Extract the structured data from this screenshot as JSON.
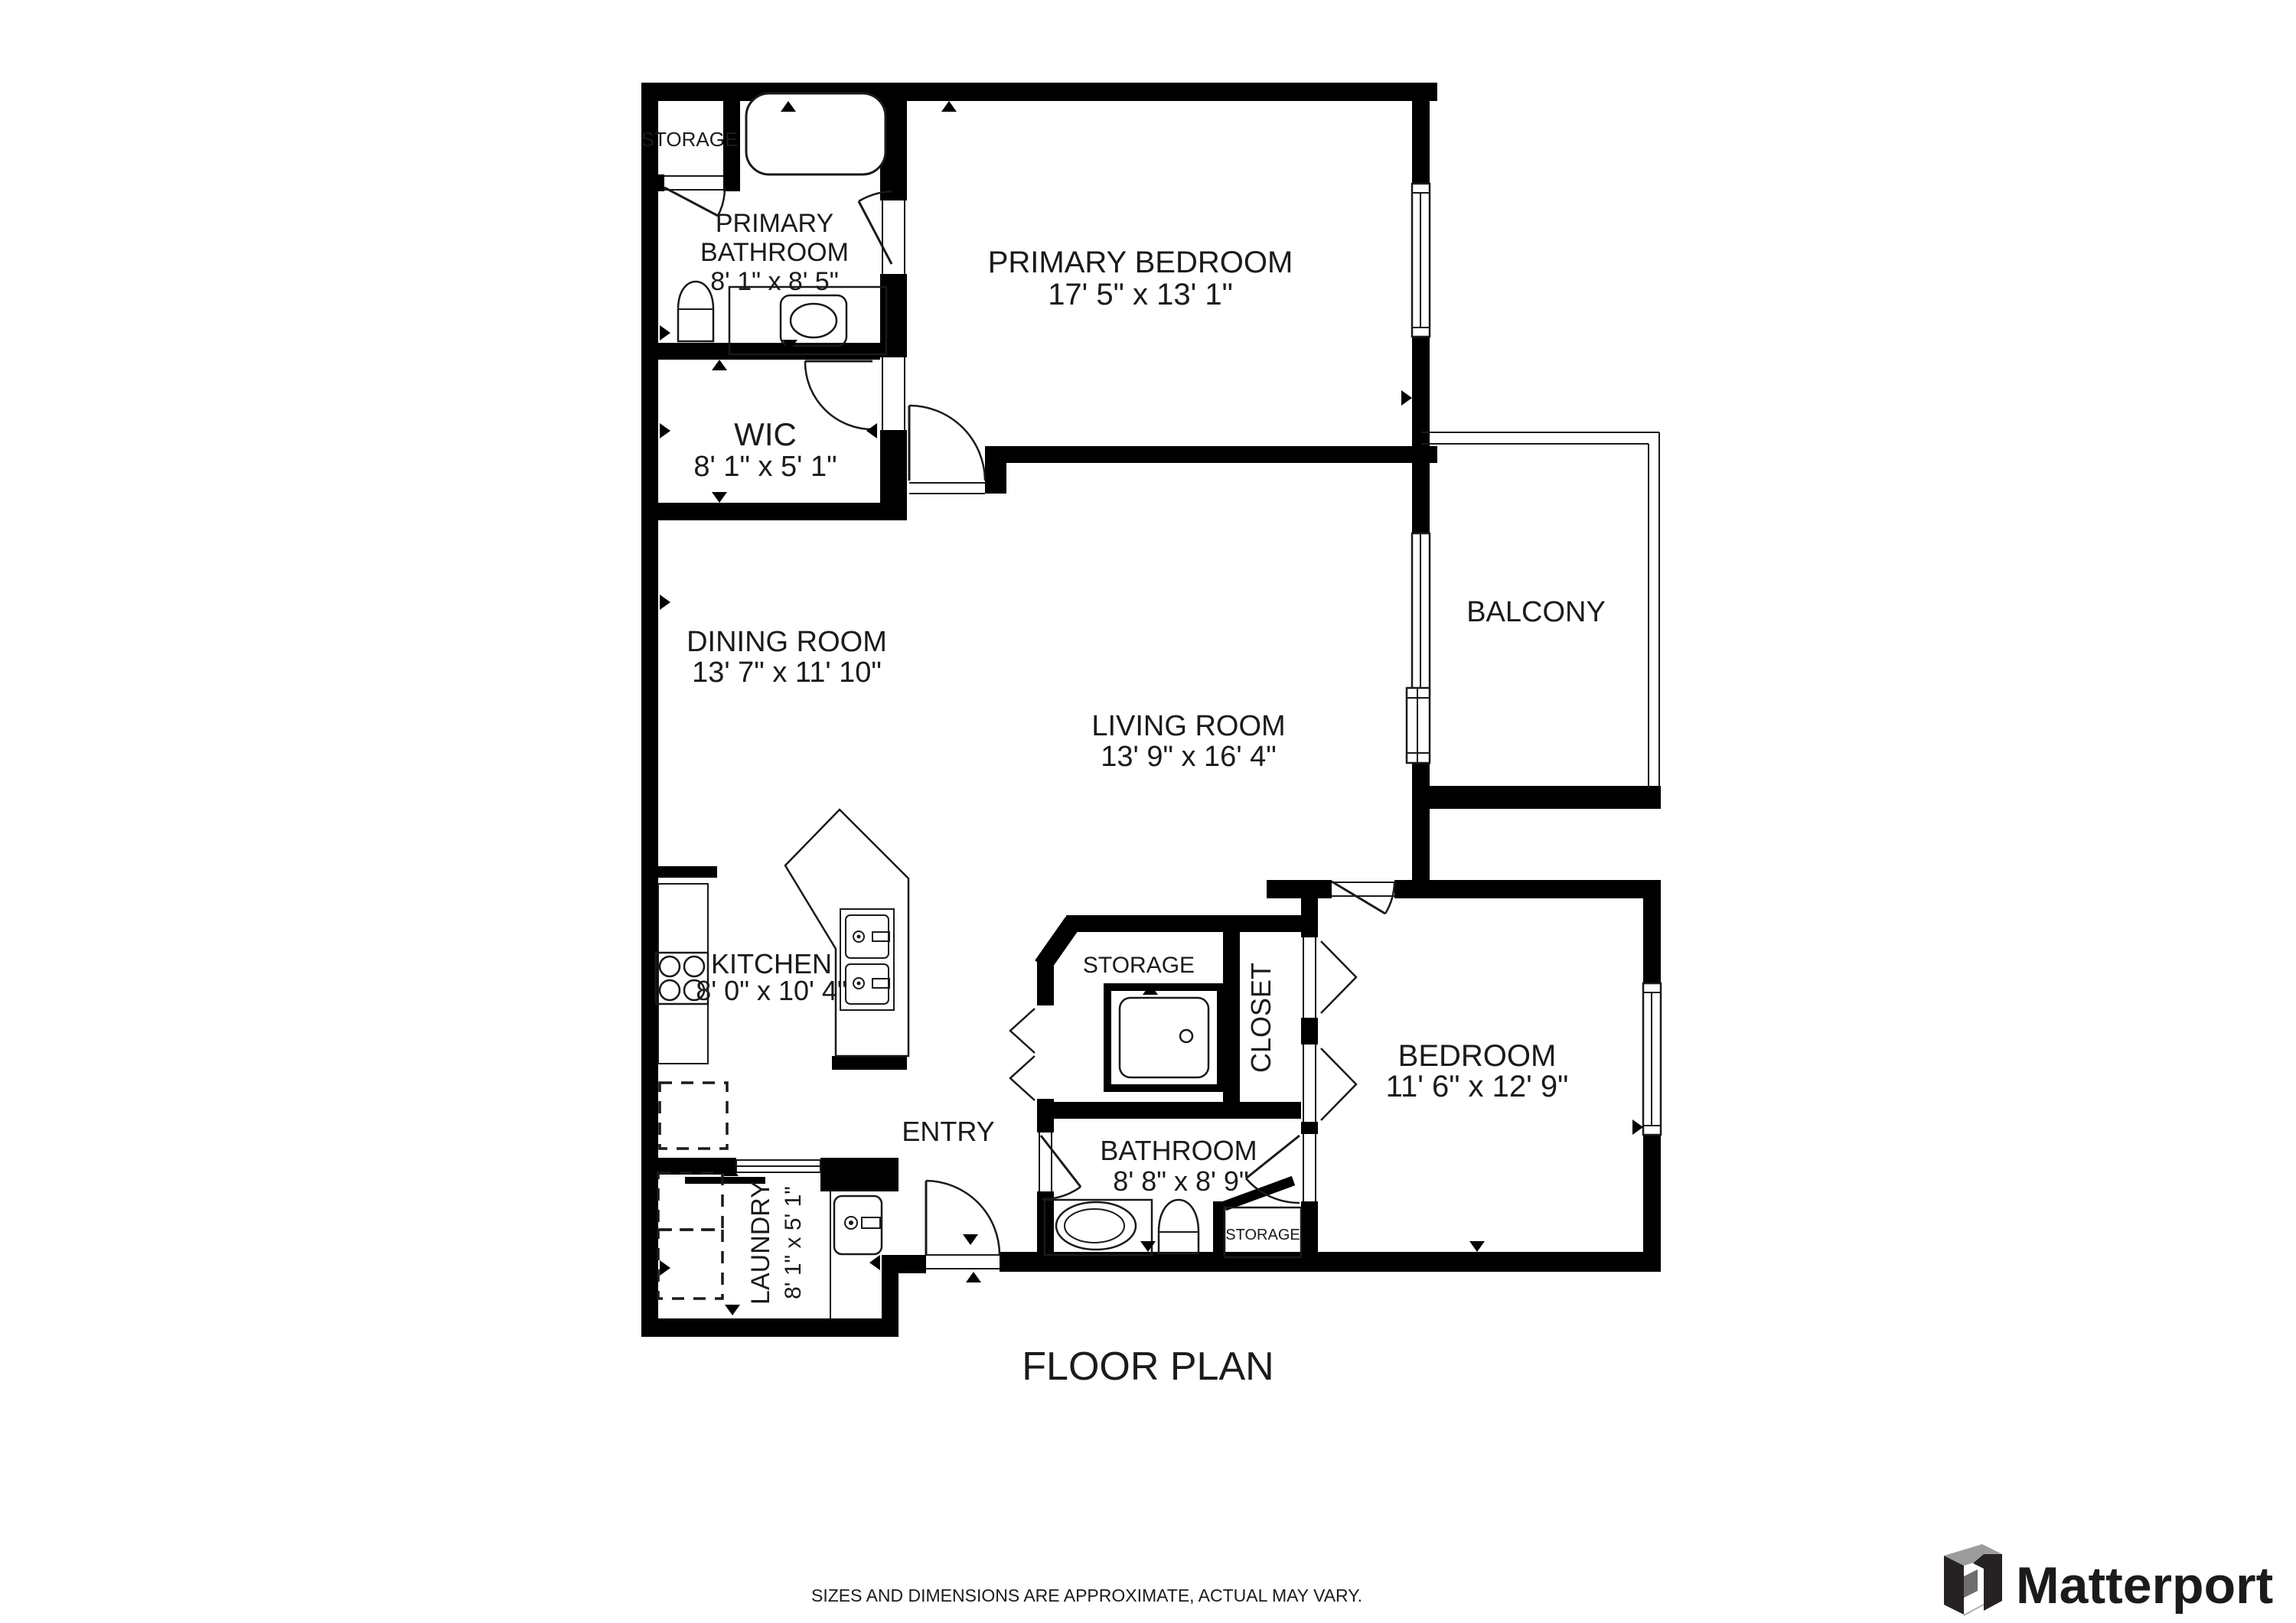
{
  "title": "FLOOR PLAN",
  "disclaimer": "SIZES AND DIMENSIONS ARE APPROXIMATE, ACTUAL MAY VARY.",
  "branding": {
    "logo_text": "Matterport"
  },
  "rooms": {
    "primary_bathroom": {
      "name_line1": "PRIMARY",
      "name_line2": "BATHROOM",
      "dims": "8' 1\" x 8' 5\""
    },
    "primary_bedroom": {
      "name": "PRIMARY BEDROOM",
      "dims": "17' 5\" x 13' 1\""
    },
    "wic": {
      "name": "WIC",
      "dims": "8' 1\" x 5' 1\""
    },
    "dining_room": {
      "name": "DINING ROOM",
      "dims": "13' 7\" x 11' 10\""
    },
    "living_room": {
      "name": "LIVING ROOM",
      "dims": "13' 9\" x 16' 4\""
    },
    "balcony": {
      "name": "BALCONY"
    },
    "kitchen": {
      "name": "KITCHEN",
      "dims": "8' 0\" x 10' 4\""
    },
    "entry": {
      "name": "ENTRY"
    },
    "bathroom": {
      "name": "BATHROOM",
      "dims": "8' 8\" x 8' 9\""
    },
    "bedroom": {
      "name": "BEDROOM",
      "dims": "11' 6\" x 12' 9\""
    },
    "closet": {
      "name": "CLOSET"
    },
    "laundry": {
      "name": "LAUNDRY",
      "dims": "8' 1\" x 5' 1\""
    },
    "storage_upper": {
      "name": "STORAGE"
    },
    "storage_hall": {
      "name": "STORAGE"
    },
    "storage_bath": {
      "name": "STORAGE"
    }
  }
}
